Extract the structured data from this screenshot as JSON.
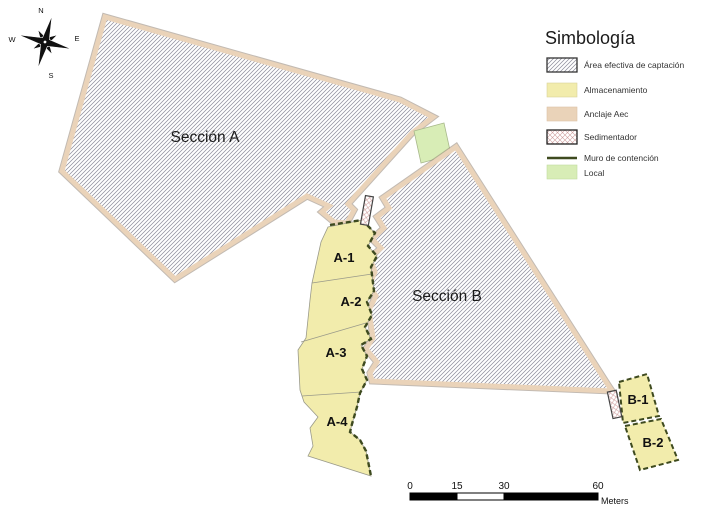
{
  "map": {
    "section_a_label": "Sección A",
    "section_b_label": "Sección B",
    "areas": {
      "a1": "A-1",
      "a2": "A-2",
      "a3": "A-3",
      "a4": "A-4",
      "b1": "B-1",
      "b2": "B-2"
    }
  },
  "compass": {
    "north": "N",
    "east": "E",
    "south": "S",
    "west": "W"
  },
  "legend": {
    "title": "Simbología",
    "items": [
      {
        "label": "Área efectiva de captación",
        "swatch": "hatch-icon"
      },
      {
        "label": "Almacenamiento",
        "swatch": "yellow-swatch"
      },
      {
        "label": "Anclaje Aec",
        "swatch": "peach-swatch"
      },
      {
        "label": "Sedimentador",
        "swatch": "crosshatch-icon"
      },
      {
        "label": "Muro de contención",
        "swatch": "dark-line"
      },
      {
        "label": "Local",
        "swatch": "green-swatch"
      }
    ]
  },
  "scale_bar": {
    "ticks": [
      "0",
      "15",
      "30",
      "60"
    ],
    "unit": "Meters"
  },
  "colors": {
    "almacenamiento": "#F2ECAC",
    "anclaje": "#EAD3B9",
    "anclaje_edge": "#8F8273",
    "local": "#D8EDB6",
    "muro": "#3E4A1F",
    "hatch_line": "#8C8C9A",
    "sediment_line": "#CF9F9F",
    "label_text": "#1A1A1A"
  }
}
